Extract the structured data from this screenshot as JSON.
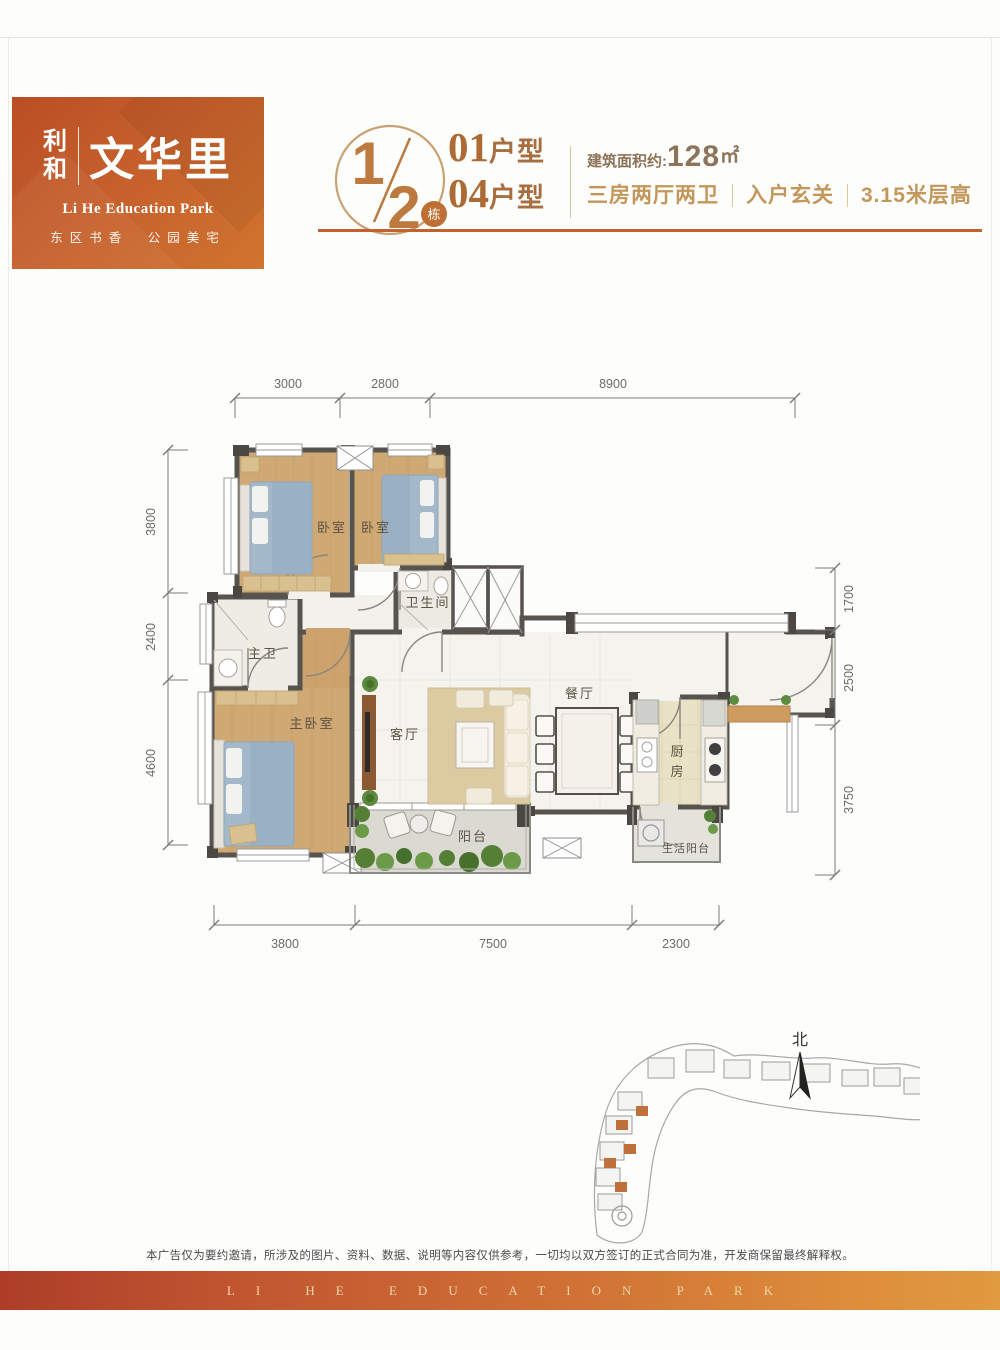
{
  "logo": {
    "brand_top": "利",
    "brand_bottom": "和",
    "name": "文华里",
    "subtitle_en": "Li He Education Park",
    "tagline": "东区书香　公园美宅",
    "gradient_start": "#b94e24",
    "gradient_end": "#d0742f"
  },
  "title": {
    "block_numerator": "1",
    "block_denominator": "2",
    "block_unit": "栋",
    "unit_types": [
      {
        "num": "01",
        "suffix": "户型"
      },
      {
        "num": "04",
        "suffix": "户型"
      }
    ],
    "area_label": "建筑面积约:",
    "area_value": "128",
    "area_unit": "㎡",
    "features": [
      "三房两厅两卫",
      "入户玄关",
      "3.15米层高"
    ],
    "accent_color": "#c4622f"
  },
  "floorplan": {
    "dims": {
      "top": [
        "3000",
        "2800",
        "8900"
      ],
      "left": [
        "3800",
        "2400",
        "4600"
      ],
      "right": [
        "1700",
        "2500",
        "3750"
      ],
      "bottom": [
        "3800",
        "7500",
        "2300"
      ]
    },
    "rooms": {
      "bedroom1": "卧室",
      "bedroom2": "卧室",
      "bathroom": "卫生间",
      "master_bath": "主卫",
      "master_bedroom": "主卧室",
      "living": "客厅",
      "dining": "餐厅",
      "kitchen_top": "厨",
      "kitchen_bottom": "房",
      "balcony": "阳台",
      "service_balcony": "生活阳台"
    }
  },
  "siteplan": {
    "north_label": "北"
  },
  "footer": {
    "disclaimer": "本广告仅为要约邀请，所涉及的图片、资料、数据、说明等内容仅供参考，一切均以双方签订的正式合同为准，开发商保留最终解释权。",
    "banner": "LI HE EDUCATION PARK"
  }
}
